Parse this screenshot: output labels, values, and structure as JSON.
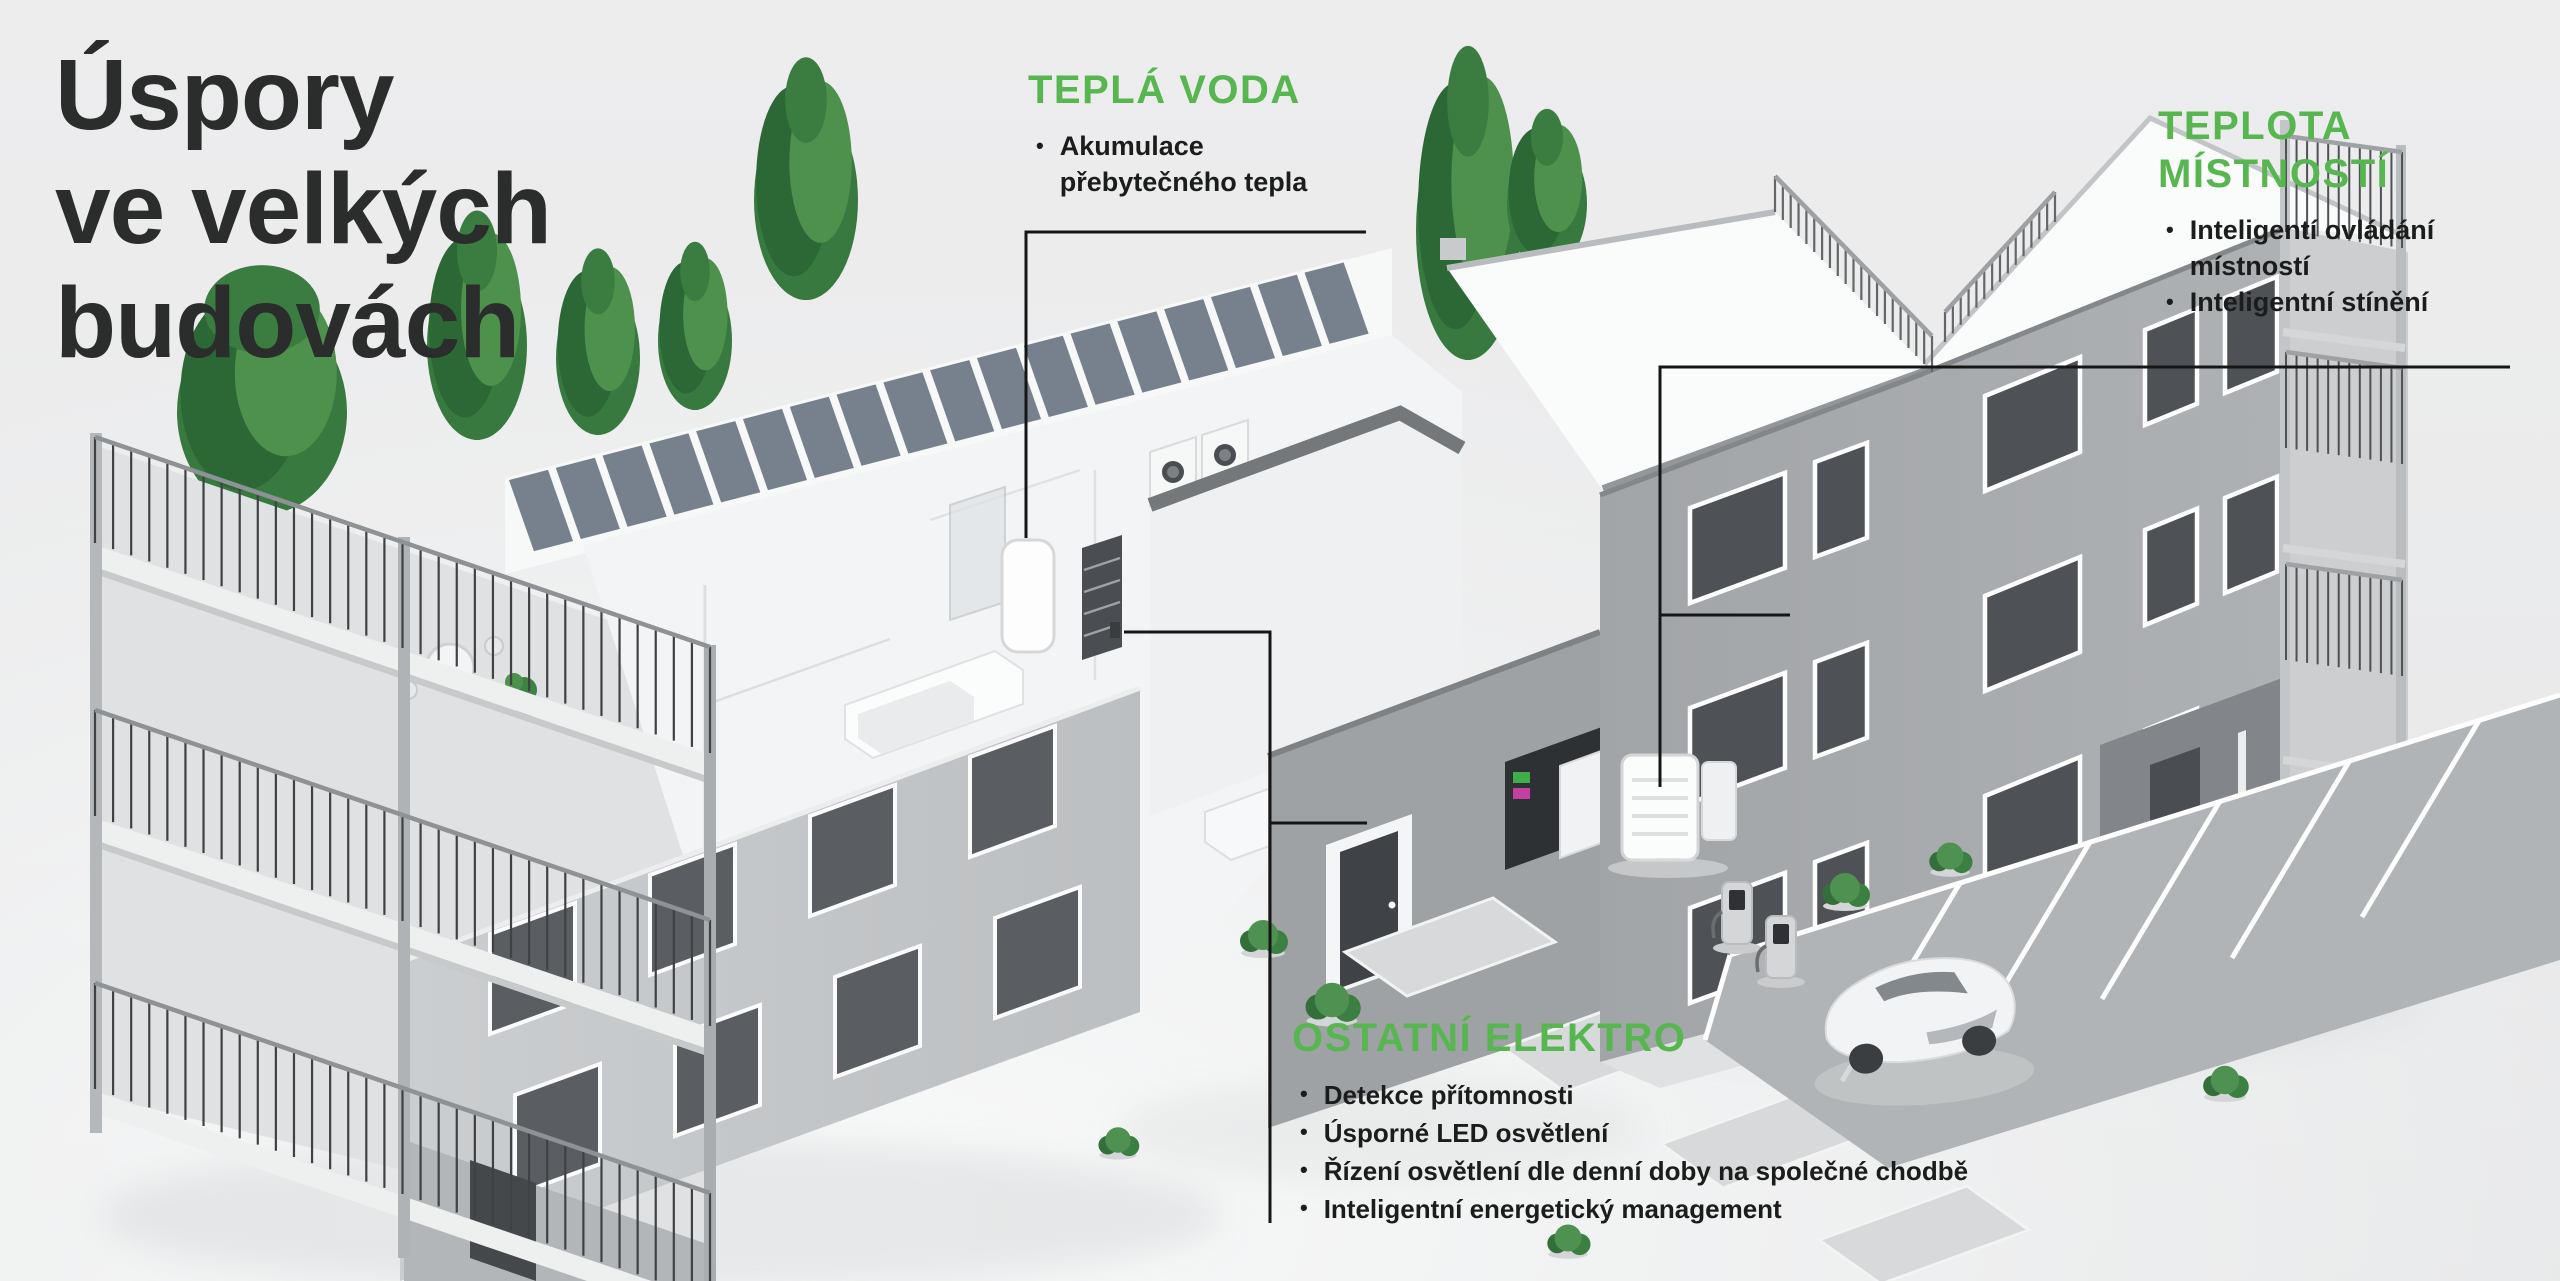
{
  "title": {
    "lines": "Úspory\nve velkých\nbudovách"
  },
  "callouts": {
    "hot_water": {
      "heading": "TEPLÁ VODA",
      "items": [
        "Akumulace přebytečného tepla"
      ]
    },
    "room_temp": {
      "heading": "TEPLOTA MÍSTNOSTÍ",
      "items": [
        "Inteligentí ovládání místností",
        "Inteligentní stínění"
      ]
    },
    "other_electro": {
      "heading": "OSTATNÍ ELEKTRO",
      "items": [
        "Detekce přítomnosti",
        "Úsporné LED osvětlení",
        "Řízení osvětlení dle denní doby na společné chodbě",
        "Inteligentní energetický management"
      ]
    }
  },
  "colors": {
    "accent_green": "#57b64f",
    "title_text": "#2b2c2c",
    "body_text": "#1b1c1c",
    "connector_line": "#161617",
    "background": "#ececed"
  }
}
